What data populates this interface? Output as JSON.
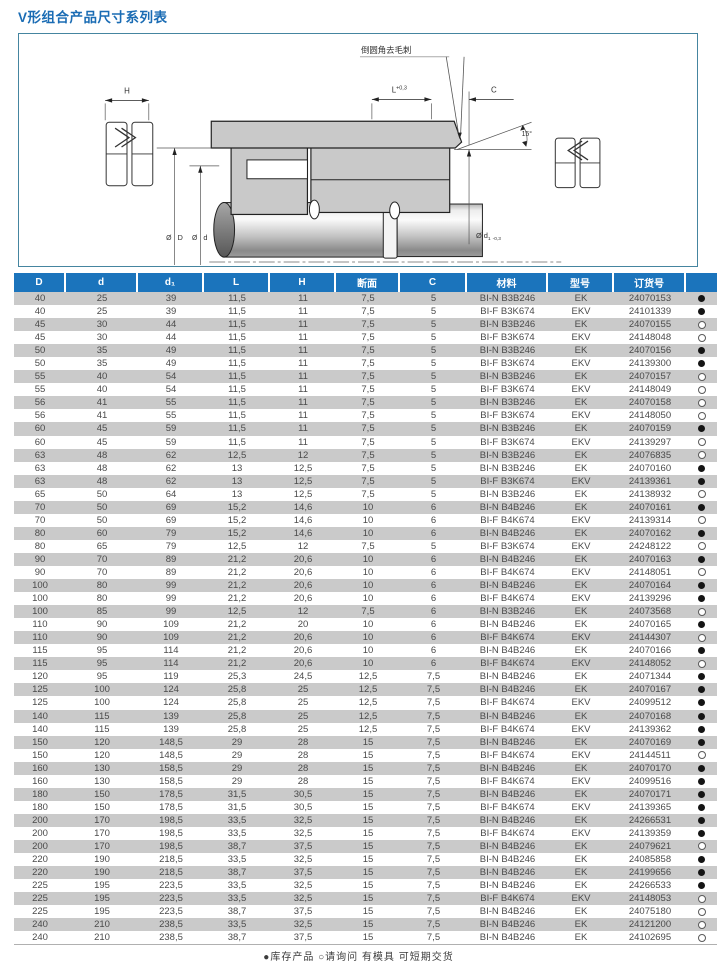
{
  "page": {
    "title": "V形组合产品尺寸系列表"
  },
  "colors": {
    "title_blue": "#1a6cb4",
    "header_blue": "#1b74bc",
    "row_stripe_gray": "#cacaca",
    "diagram_border": "#4585a0",
    "drawing_gray": "#c9c9c9"
  },
  "diagram": {
    "callout": "倒圆角去毛刺",
    "dim_H": "H",
    "dim_L": "L",
    "dim_L_tol": "+0,3",
    "dim_C": "C",
    "angle": "15°",
    "dia_D_sym": "Ø",
    "dia_D": "D",
    "dia_d_sym": "Ø",
    "dia_d": "d",
    "dia_d1": "Ø d",
    "dia_d1_sub": "1",
    "dia_d1_tol": "-0,3"
  },
  "table": {
    "headers": [
      "D",
      "d",
      "d₁",
      "L",
      "H",
      "断面",
      "C",
      "材料",
      "型号",
      "订货号",
      ""
    ],
    "rows": [
      [
        "40",
        "25",
        "39",
        "11,5",
        "11",
        "7,5",
        "5",
        "BI-N B3B246",
        "EK",
        "24070153",
        "filled"
      ],
      [
        "40",
        "25",
        "39",
        "11,5",
        "11",
        "7,5",
        "5",
        "BI-F B3K674",
        "EKV",
        "24101339",
        "filled"
      ],
      [
        "45",
        "30",
        "44",
        "11,5",
        "11",
        "7,5",
        "5",
        "BI-N B3B246",
        "EK",
        "24070155",
        "open"
      ],
      [
        "45",
        "30",
        "44",
        "11,5",
        "11",
        "7,5",
        "5",
        "BI-F B3K674",
        "EKV",
        "24148048",
        "open"
      ],
      [
        "50",
        "35",
        "49",
        "11,5",
        "11",
        "7,5",
        "5",
        "BI-N B3B246",
        "EK",
        "24070156",
        "filled"
      ],
      [
        "50",
        "35",
        "49",
        "11,5",
        "11",
        "7,5",
        "5",
        "BI-F B3K674",
        "EKV",
        "24139300",
        "filled"
      ],
      [
        "55",
        "40",
        "54",
        "11,5",
        "11",
        "7,5",
        "5",
        "BI-N B3B246",
        "EK",
        "24070157",
        "open"
      ],
      [
        "55",
        "40",
        "54",
        "11,5",
        "11",
        "7,5",
        "5",
        "BI-F B3K674",
        "EKV",
        "24148049",
        "open"
      ],
      [
        "56",
        "41",
        "55",
        "11,5",
        "11",
        "7,5",
        "5",
        "BI-N B3B246",
        "EK",
        "24070158",
        "open"
      ],
      [
        "56",
        "41",
        "55",
        "11,5",
        "11",
        "7,5",
        "5",
        "BI-F B3K674",
        "EKV",
        "24148050",
        "open"
      ],
      [
        "60",
        "45",
        "59",
        "11,5",
        "11",
        "7,5",
        "5",
        "BI-N B3B246",
        "EK",
        "24070159",
        "filled"
      ],
      [
        "60",
        "45",
        "59",
        "11,5",
        "11",
        "7,5",
        "5",
        "BI-F B3K674",
        "EKV",
        "24139297",
        "open"
      ],
      [
        "63",
        "48",
        "62",
        "12,5",
        "12",
        "7,5",
        "5",
        "BI-N B3B246",
        "EK",
        "24076835",
        "open"
      ],
      [
        "63",
        "48",
        "62",
        "13",
        "12,5",
        "7,5",
        "5",
        "BI-N B3B246",
        "EK",
        "24070160",
        "filled"
      ],
      [
        "63",
        "48",
        "62",
        "13",
        "12,5",
        "7,5",
        "5",
        "BI-F B3K674",
        "EKV",
        "24139361",
        "filled"
      ],
      [
        "65",
        "50",
        "64",
        "13",
        "12,5",
        "7,5",
        "5",
        "BI-N B3B246",
        "EK",
        "24138932",
        "open"
      ],
      [
        "70",
        "50",
        "69",
        "15,2",
        "14,6",
        "10",
        "6",
        "BI-N B4B246",
        "EK",
        "24070161",
        "filled"
      ],
      [
        "70",
        "50",
        "69",
        "15,2",
        "14,6",
        "10",
        "6",
        "BI-F B4K674",
        "EKV",
        "24139314",
        "open"
      ],
      [
        "80",
        "60",
        "79",
        "15,2",
        "14,6",
        "10",
        "6",
        "BI-N B4B246",
        "EK",
        "24070162",
        "filled"
      ],
      [
        "80",
        "65",
        "79",
        "12,5",
        "12",
        "7,5",
        "5",
        "BI-F B3K674",
        "EKV",
        "24248122",
        "open"
      ],
      [
        "90",
        "70",
        "89",
        "21,2",
        "20,6",
        "10",
        "6",
        "BI-N B4B246",
        "EK",
        "24070163",
        "filled"
      ],
      [
        "90",
        "70",
        "89",
        "21,2",
        "20,6",
        "10",
        "6",
        "BI-F B4K674",
        "EKV",
        "24148051",
        "open"
      ],
      [
        "100",
        "80",
        "99",
        "21,2",
        "20,6",
        "10",
        "6",
        "BI-N B4B246",
        "EK",
        "24070164",
        "filled"
      ],
      [
        "100",
        "80",
        "99",
        "21,2",
        "20,6",
        "10",
        "6",
        "BI-F B4K674",
        "EKV",
        "24139296",
        "filled"
      ],
      [
        "100",
        "85",
        "99",
        "12,5",
        "12",
        "7,5",
        "6",
        "BI-N B3B246",
        "EK",
        "24073568",
        "open"
      ],
      [
        "110",
        "90",
        "109",
        "21,2",
        "20",
        "10",
        "6",
        "BI-N B4B246",
        "EK",
        "24070165",
        "filled"
      ],
      [
        "110",
        "90",
        "109",
        "21,2",
        "20,6",
        "10",
        "6",
        "BI-F B4K674",
        "EKV",
        "24144307",
        "open"
      ],
      [
        "115",
        "95",
        "114",
        "21,2",
        "20,6",
        "10",
        "6",
        "BI-N B4B246",
        "EK",
        "24070166",
        "filled"
      ],
      [
        "115",
        "95",
        "114",
        "21,2",
        "20,6",
        "10",
        "6",
        "BI-F B4K674",
        "EKV",
        "24148052",
        "open"
      ],
      [
        "120",
        "95",
        "119",
        "25,3",
        "24,5",
        "12,5",
        "7,5",
        "BI-N B4B246",
        "EK",
        "24071344",
        "filled"
      ],
      [
        "125",
        "100",
        "124",
        "25,8",
        "25",
        "12,5",
        "7,5",
        "BI-N B4B246",
        "EK",
        "24070167",
        "filled"
      ],
      [
        "125",
        "100",
        "124",
        "25,8",
        "25",
        "12,5",
        "7,5",
        "BI-F B4K674",
        "EKV",
        "24099512",
        "filled"
      ],
      [
        "140",
        "115",
        "139",
        "25,8",
        "25",
        "12,5",
        "7,5",
        "BI-N B4B246",
        "EK",
        "24070168",
        "filled"
      ],
      [
        "140",
        "115",
        "139",
        "25,8",
        "25",
        "12,5",
        "7,5",
        "BI-F B4K674",
        "EKV",
        "24139362",
        "filled"
      ],
      [
        "150",
        "120",
        "148,5",
        "29",
        "28",
        "15",
        "7,5",
        "BI-N B4B246",
        "EK",
        "24070169",
        "filled"
      ],
      [
        "150",
        "120",
        "148,5",
        "29",
        "28",
        "15",
        "7,5",
        "BI-F B4K674",
        "EKV",
        "24144511",
        "open"
      ],
      [
        "160",
        "130",
        "158,5",
        "29",
        "28",
        "15",
        "7,5",
        "BI-N B4B246",
        "EK",
        "24070170",
        "filled"
      ],
      [
        "160",
        "130",
        "158,5",
        "29",
        "28",
        "15",
        "7,5",
        "BI-F B4K674",
        "EKV",
        "24099516",
        "filled"
      ],
      [
        "180",
        "150",
        "178,5",
        "31,5",
        "30,5",
        "15",
        "7,5",
        "BI-N B4B246",
        "EK",
        "24070171",
        "filled"
      ],
      [
        "180",
        "150",
        "178,5",
        "31,5",
        "30,5",
        "15",
        "7,5",
        "BI-F B4K674",
        "EKV",
        "24139365",
        "filled"
      ],
      [
        "200",
        "170",
        "198,5",
        "33,5",
        "32,5",
        "15",
        "7,5",
        "BI-N B4B246",
        "EK",
        "24266531",
        "filled"
      ],
      [
        "200",
        "170",
        "198,5",
        "33,5",
        "32,5",
        "15",
        "7,5",
        "BI-F B4K674",
        "EKV",
        "24139359",
        "filled"
      ],
      [
        "200",
        "170",
        "198,5",
        "38,7",
        "37,5",
        "15",
        "7,5",
        "BI-N B4B246",
        "EK",
        "24079621",
        "open"
      ],
      [
        "220",
        "190",
        "218,5",
        "33,5",
        "32,5",
        "15",
        "7,5",
        "BI-N B4B246",
        "EK",
        "24085858",
        "filled"
      ],
      [
        "220",
        "190",
        "218,5",
        "38,7",
        "37,5",
        "15",
        "7,5",
        "BI-N B4B246",
        "EK",
        "24199656",
        "filled"
      ],
      [
        "225",
        "195",
        "223,5",
        "33,5",
        "32,5",
        "15",
        "7,5",
        "BI-N B4B246",
        "EK",
        "24266533",
        "filled"
      ],
      [
        "225",
        "195",
        "223,5",
        "33,5",
        "32,5",
        "15",
        "7,5",
        "BI-F B4K674",
        "EKV",
        "24148053",
        "open"
      ],
      [
        "225",
        "195",
        "223,5",
        "38,7",
        "37,5",
        "15",
        "7,5",
        "BI-N B4B246",
        "EK",
        "24075180",
        "open"
      ],
      [
        "240",
        "210",
        "238,5",
        "33,5",
        "32,5",
        "15",
        "7,5",
        "BI-N B4B246",
        "EK",
        "24121200",
        "open"
      ],
      [
        "240",
        "210",
        "238,5",
        "38,7",
        "37,5",
        "15",
        "7,5",
        "BI-N B4B246",
        "EK",
        "24102695",
        "open"
      ]
    ]
  },
  "footer": {
    "legend": "●库存产品  ○请询问  有模具  可短期交货"
  }
}
